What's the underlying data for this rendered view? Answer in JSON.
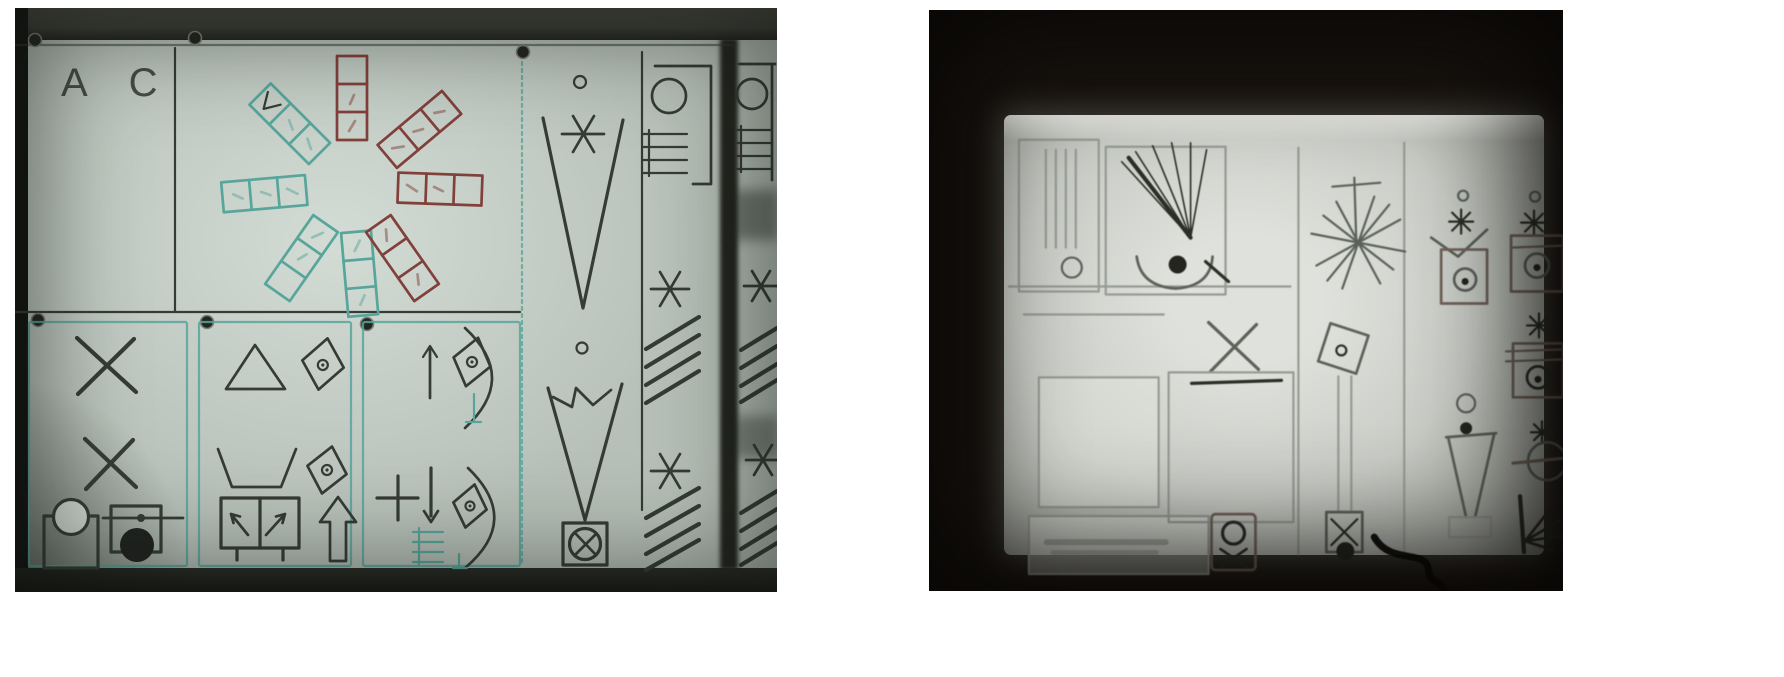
{
  "photos": {
    "left": {
      "name": "photo of hand-drawn symbol chart on a light board",
      "board_label": "A C",
      "icons": {
        "pushpin": "dark round pin",
        "tally-strip-fan": "pinwheel of eight 3-cell strips, teal left half, dark-red right half",
        "small-circle": "o",
        "asterisk": "*",
        "tapered-v": "V",
        "zigzag-v": "V with N scribble",
        "crossed-box-circle": "circle with X inside a square",
        "coil-bracket": "ring + comb lines + square bracket",
        "hatch-shading": "four slanted parallel lines",
        "x-mark": "X",
        "circle-on-square": "circle resting on open square",
        "square-plunger-dot": "square with rod, small dot and filled ball",
        "triangle": "open triangle",
        "diamond-with-dot": "tilted diamond with small circle",
        "open-trapezoid": "flat-bottom open V",
        "boxed-bent-arrows": "two bent arrows in a split box with legs",
        "outline-up-arrow": "large outlined up arrow",
        "thin-up-arrow": "up arrow",
        "down-arrow": "down arrow",
        "plus-sign": "+",
        "closing-arc": ")",
        "tally-comb": "short comb of horizontal lines"
      }
    },
    "right": {
      "name": "dark photo of backlit screen with faint symbol chart",
      "caption_legible": false,
      "icons": {
        "ruled-box": "box with vertical rules and circle",
        "brush-spray": "dark quill fan of strokes",
        "cup-with-dot": "open cup holding dark dot",
        "starburst": "many-rayed star with mast and crossbar",
        "dot-star-pot": "dot over star over pot box",
        "x-mark": "X with underline",
        "folding-fan": "dark folding hand fan on a bar",
        "blank-panel": "empty bright panel",
        "pot-with-hourglass": "box with ring and crossed hourglass",
        "tilted-square-dropline": "tilted square with long double drop line to small crossed box and dark dot",
        "star-pot": "star over pot box with crossbars",
        "funnel-with-dots": "circle and dot above narrow funnel on pedestal",
        "star-crossed-circle": "star over circle crossed by bar",
        "ray-fan": "vertical stroke with rays fanning right",
        "power-cable": "dark cable below screen"
      }
    }
  },
  "colors": {
    "page-bg": "#ffffff",
    "board": "#b6c0b8",
    "board-bright": "#ccd6ce",
    "ink": "#353b35",
    "teal": "#58a59b",
    "red": "#82403b",
    "band": "#3d3e38",
    "pin-fill": "#23251f",
    "pin-rim": "#7a8077",
    "rp-bg": "#191410",
    "rp-screen": "#c9ccc6",
    "rp-screen-bright": "#dfe1dc",
    "rp-faint": "#969b94",
    "rp-mid": "#5c615a",
    "rp-dark": "#2b2d26",
    "rp-brown": "#6f635a",
    "cable": "#0b0a08"
  }
}
